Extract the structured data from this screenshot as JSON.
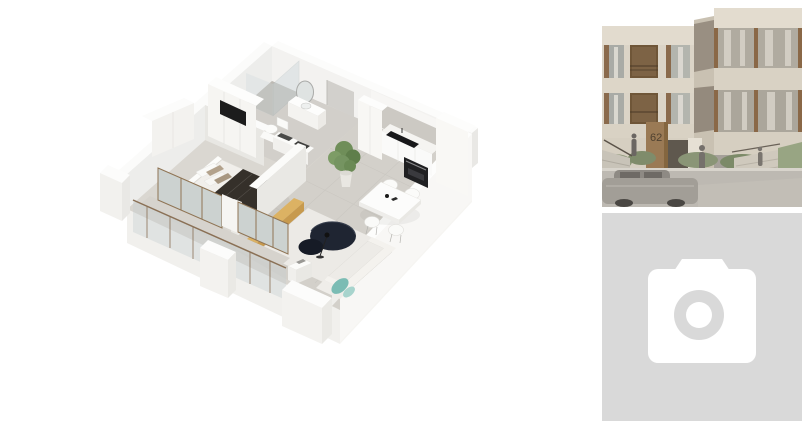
{
  "gallery": {
    "main_image": {
      "name": "apartment-3d-floorplan"
    },
    "thumbnails": {
      "building": {
        "name": "building-exterior-render",
        "house_number": "62"
      },
      "placeholder": {
        "name": "empty-photo-placeholder",
        "icon": "camera-icon"
      }
    }
  },
  "palette": {
    "canvas_bg": "#ffffff",
    "placeholder_bg": "#d9d9d9",
    "camera_icon": "#ffffff",
    "floor_grey": "#d6d3cd",
    "wall_white": "#f7f6f4",
    "bed_blanket_dark": "#35302a",
    "bench_wood": "#dcb263",
    "ottoman_navy": "#1f2532",
    "sofa_pillow_teal": "#7bbcb4",
    "plant_green": "#6f8e59",
    "facade_beige": "#dbd4c7",
    "window_wood_brown": "#8a6847",
    "balcony_recess_brown": "#6f5638"
  }
}
